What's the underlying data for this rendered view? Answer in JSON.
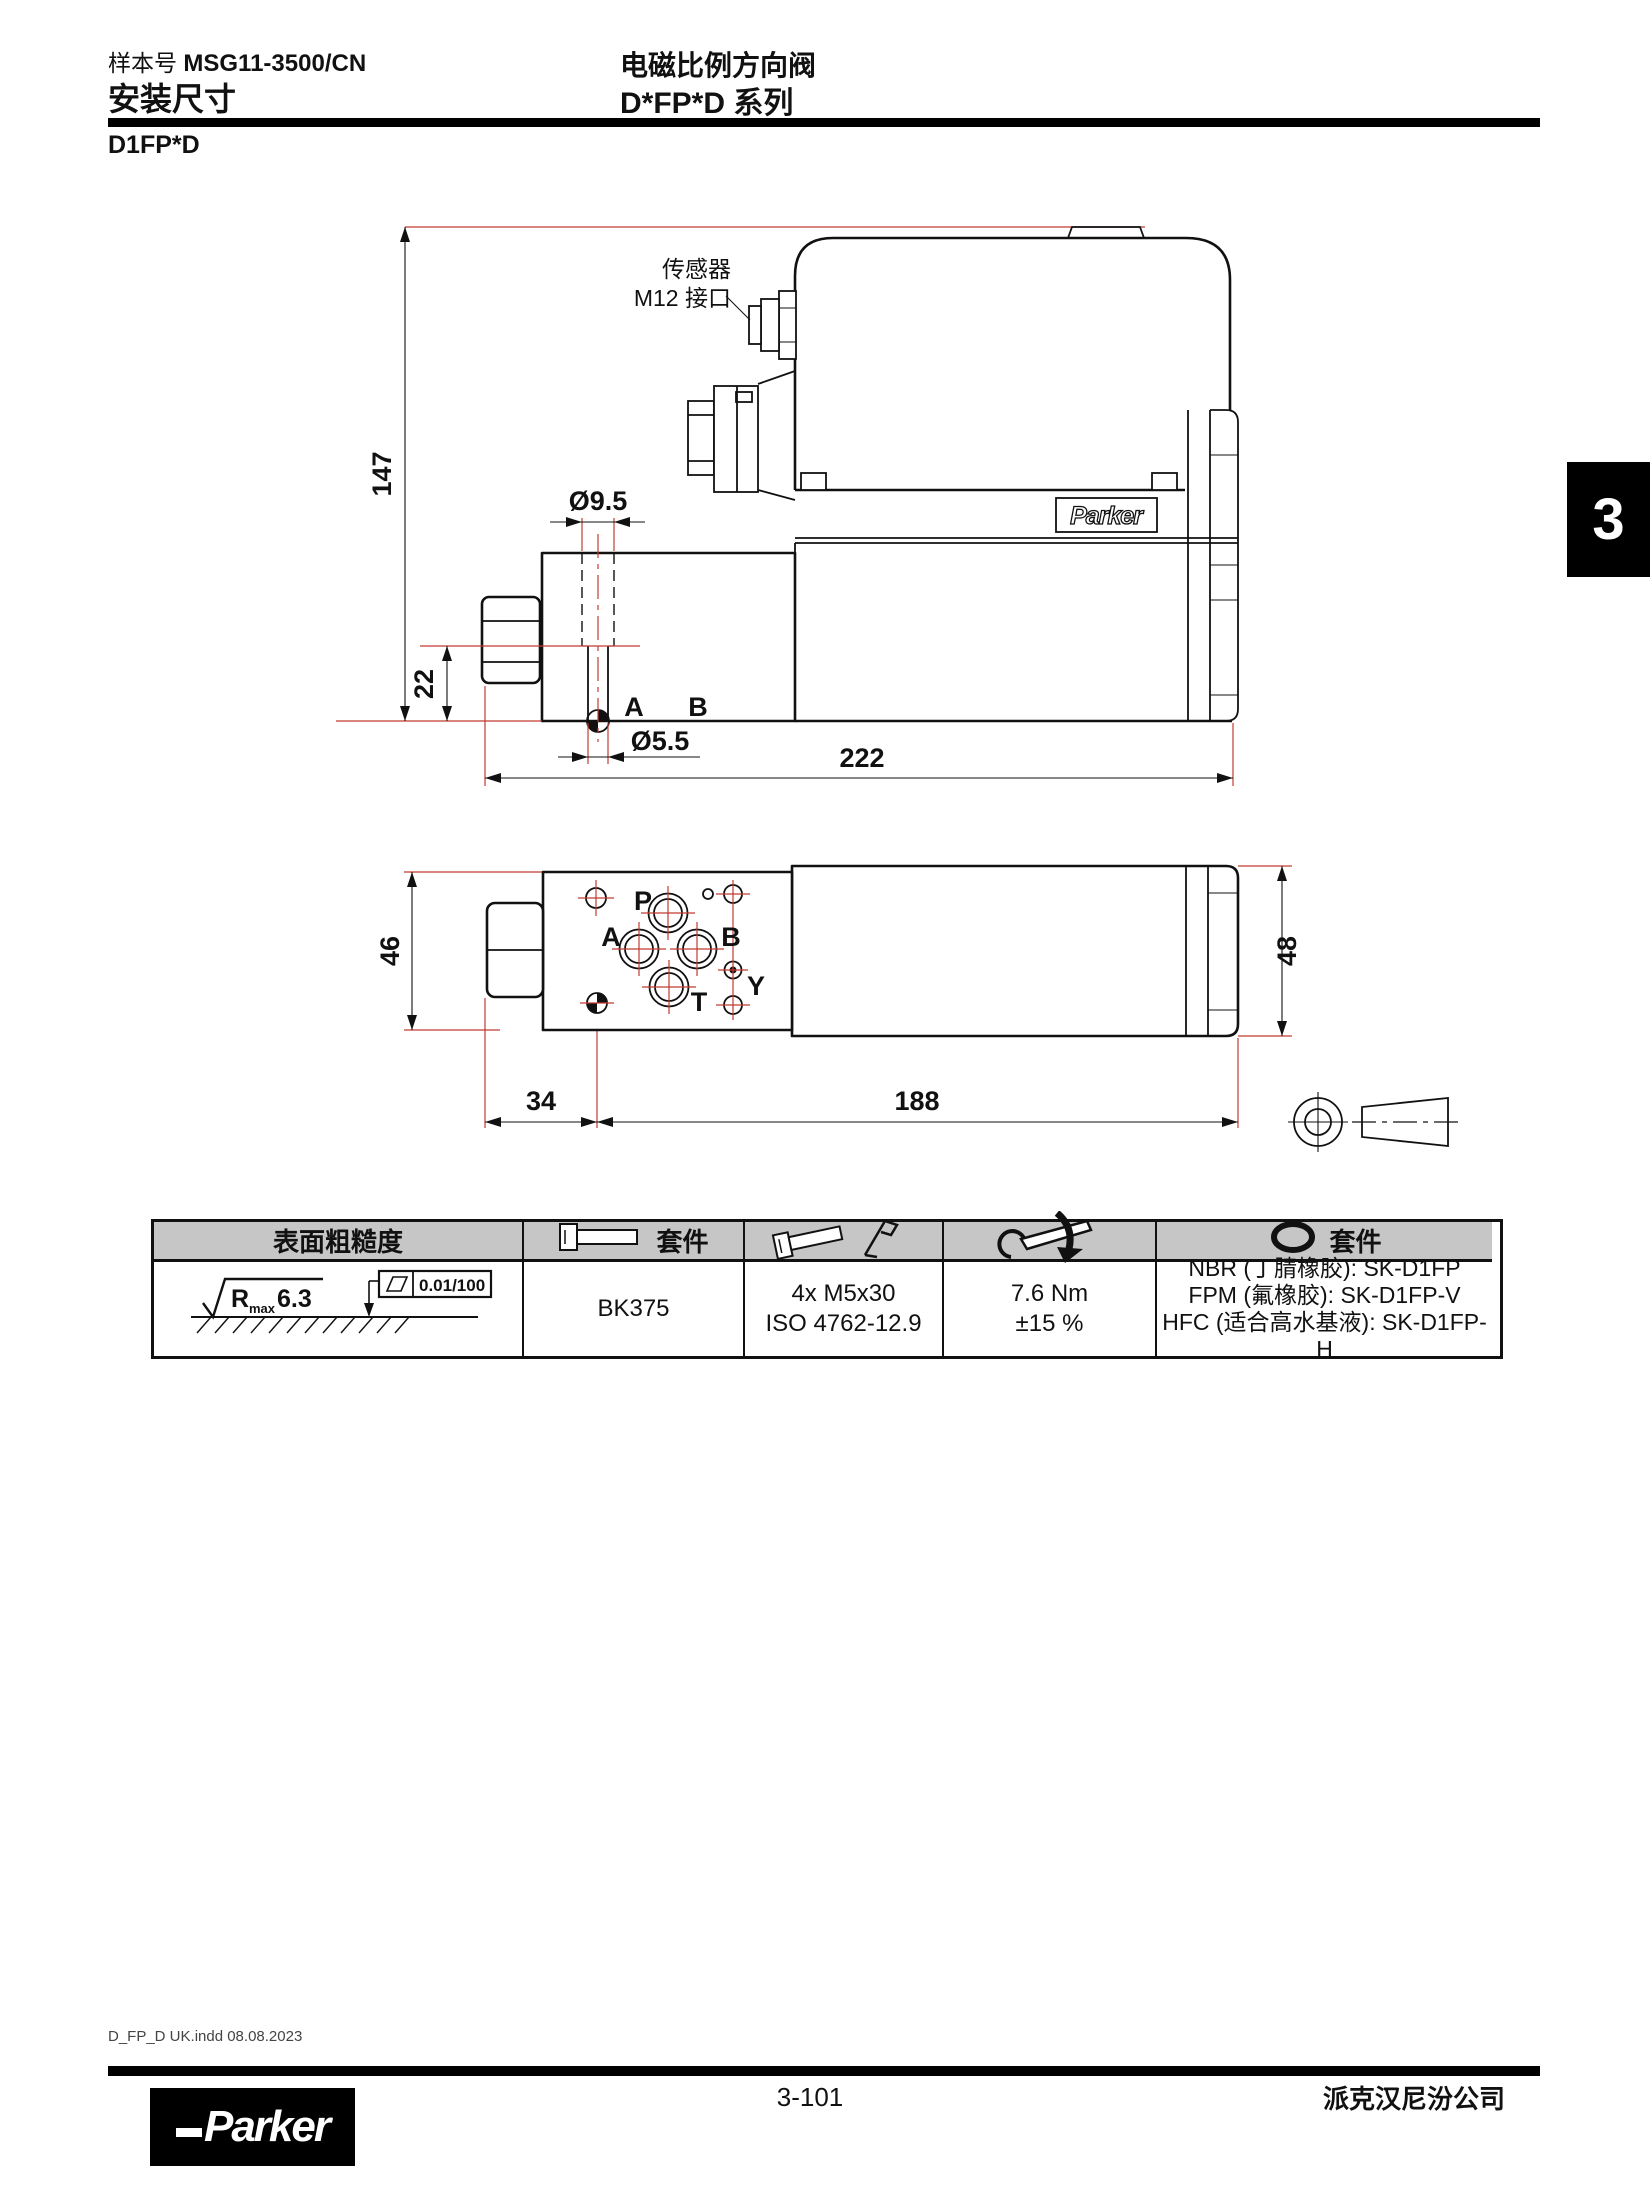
{
  "page": {
    "catalog_label": "样本号",
    "catalog_number": "MSG11-3500/CN",
    "section_title": "安装尺寸",
    "product_title": "电磁比例方向阀",
    "series_title": "D*FP*D 系列",
    "model_heading": "D1FP*D",
    "side_tab": "3"
  },
  "drawing": {
    "sensor_label_line1": "传感器",
    "sensor_label_line2": "M12 接口",
    "brand": "Parker",
    "dims": {
      "height_overall": "147",
      "height_port": "22",
      "dia_counterbore": "Ø9.5",
      "dia_hole": "Ø5.5",
      "length_overall": "222",
      "body_width": "46",
      "tube_width": "48",
      "datum_offset": "34",
      "tube_length": "188"
    },
    "ports": {
      "p": "P",
      "a": "A",
      "b": "B",
      "t": "T",
      "y": "Y"
    },
    "view1_ports": {
      "a": "A",
      "b": "B"
    }
  },
  "table": {
    "col1_header": "表面粗糙度",
    "col2_header_label": "套件",
    "col5_header_label": "套件",
    "roughness": {
      "r": "R",
      "sub": "max",
      "value": "6.3",
      "flatness": "0.01/100"
    },
    "bolt_kit": "BK375",
    "screws_line1": "4x M5x30",
    "screws_line2": "ISO 4762-12.9",
    "torque_line1": "7.6 Nm",
    "torque_line2": "±15 %",
    "seal_kits": [
      "NBR (丁腈橡胶): SK-D1FP",
      "FPM (氟橡胶): SK-D1FP-V",
      "HFC (适合高水基液): SK-D1FP-H"
    ]
  },
  "footer": {
    "imprint": "D_FP_D UK.indd 08.08.2023",
    "page_number": "3-101",
    "company": "派克汉尼汾公司",
    "logo_text": "Parker"
  },
  "colors": {
    "dimension_red": "#c43a31",
    "line_black": "#111111",
    "table_header_bg": "#c6c6c6",
    "tab_bg": "#000000"
  }
}
